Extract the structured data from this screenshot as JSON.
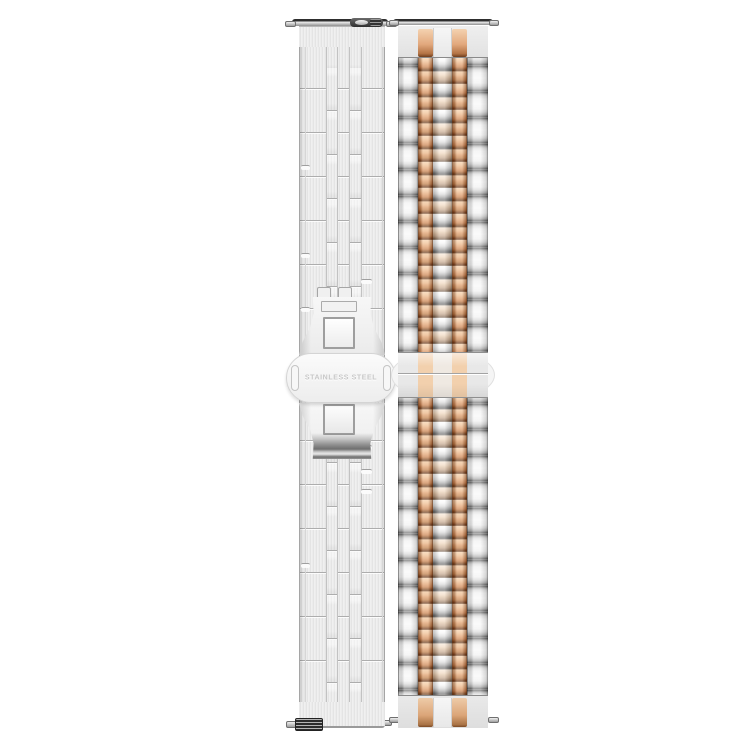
{
  "image": {
    "type": "product-photo",
    "subject": "stainless steel watch band, back view (silver, folded butterfly clasp) and front view (silver with rose gold center links, jubilee style)",
    "background_color": "#ffffff"
  },
  "back_strap": {
    "finish": "brushed silver",
    "clasp_engraving": "STAINLESS STEEL"
  },
  "front_strap": {
    "finish": "polished two-tone",
    "accent": "rose gold middle links"
  },
  "colors": {
    "silver_highlight": "#f7f7f7",
    "silver_mid": "#d2d2d2",
    "silver_shadow": "#565656",
    "rose_gold_highlight": "#f6d7b9",
    "rose_gold_mid": "#e0a477",
    "rose_gold_shadow": "#552e15",
    "engraving_text": "#c6c6c6"
  }
}
